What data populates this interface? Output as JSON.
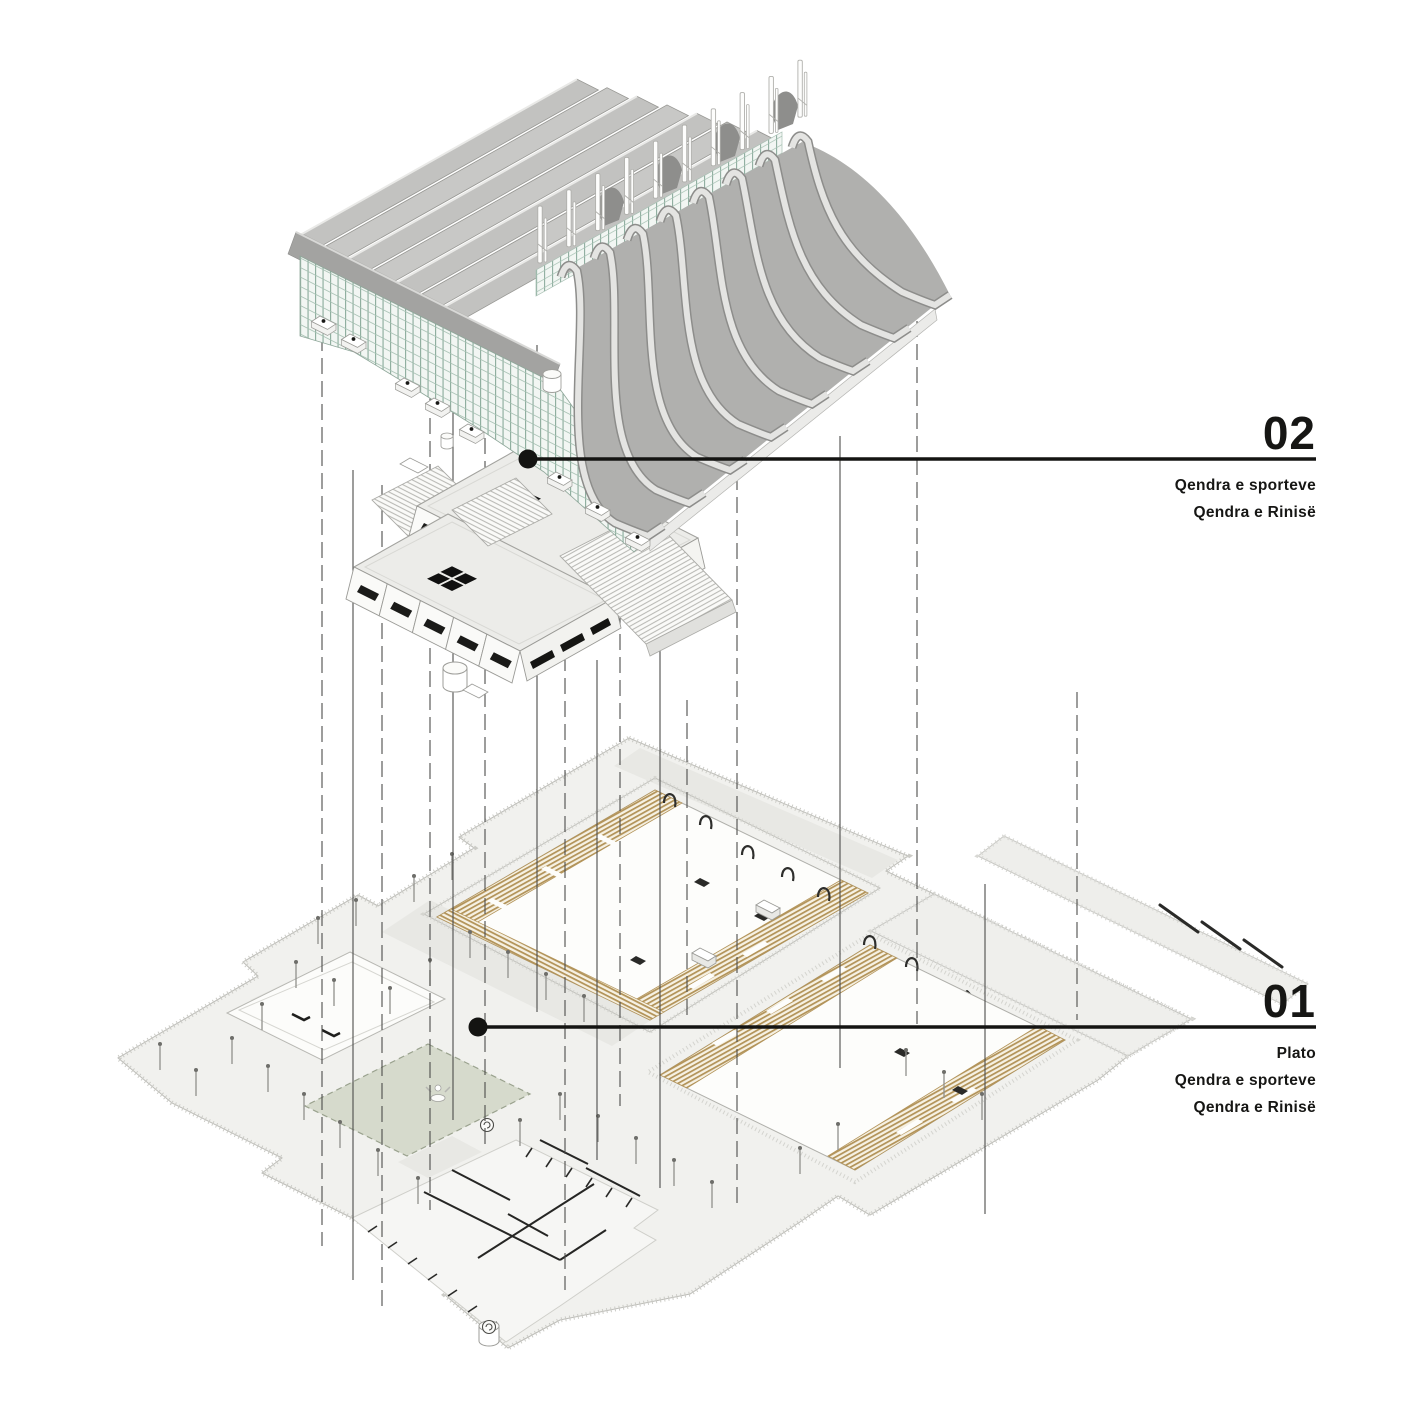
{
  "diagram": {
    "type": "exploded-axonometric-architecture-diagram",
    "annotations": {
      "level02": {
        "number": "02",
        "lines": [
          "Qendra e sporteve",
          "Qendra e Rinisë"
        ]
      },
      "level01": {
        "number": "01",
        "lines": [
          "Plato",
          "Qendra e sporteve",
          "Qendra e Rinisë"
        ]
      }
    },
    "palette": {
      "roof_gray": "#b0b0ae",
      "rib_light": "#e4e4e2",
      "glazing_teal": "#8aab9b",
      "block_roof": "#ecece9",
      "tribune_tan": "#b3945a",
      "plaza": "#f1f1ee",
      "green_court": "#d6dacc",
      "ink": "#141412"
    }
  }
}
